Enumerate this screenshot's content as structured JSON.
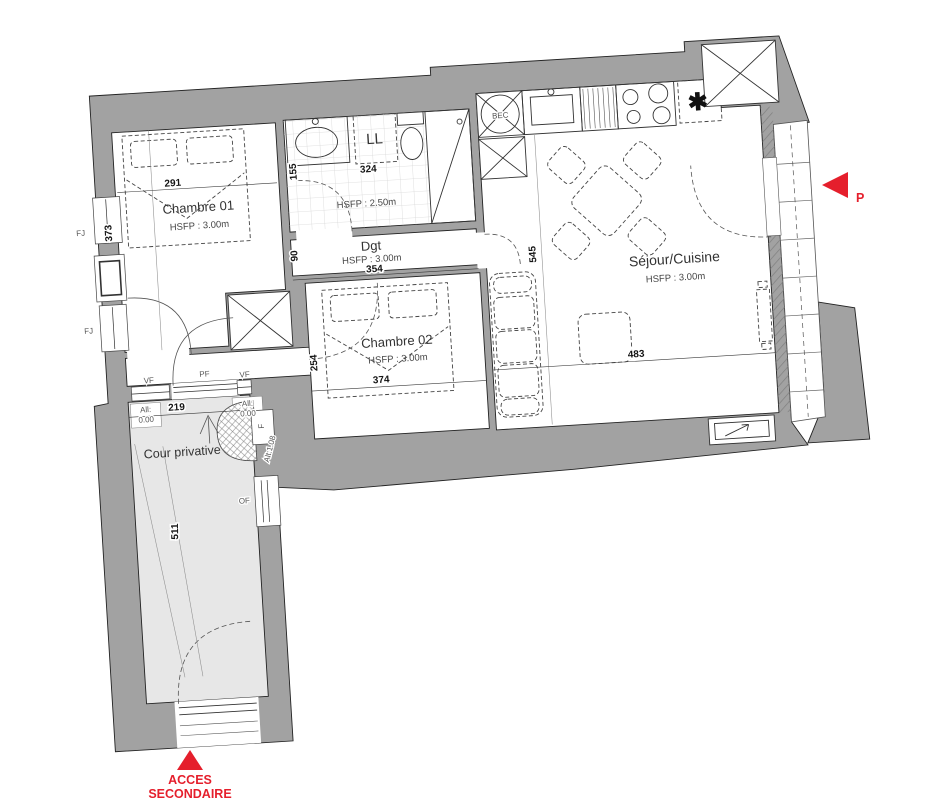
{
  "rooms": {
    "chambre01": {
      "label": "Chambre 01",
      "hsfp": "HSFP : 3.00m",
      "dim_width": "291",
      "dim_depth": "373"
    },
    "salle_eau": {
      "hsfp": "HSFP : 2.50m",
      "dim_width": "324",
      "dim_depth": "155",
      "washer_label": "LL"
    },
    "degagement": {
      "label": "Dgt",
      "hsfp": "HSFP : 3.00m",
      "dim_width": "354",
      "dim_depth": "90"
    },
    "chambre02": {
      "label": "Chambre 02",
      "hsfp": "HSFP : 3.00m",
      "dim_width": "374",
      "dim_depth": "254"
    },
    "sejour_cuisine": {
      "label": "Séjour/Cuisine",
      "hsfp": "HSFP : 3.00m",
      "dim_width": "483",
      "dim_depth": "545"
    },
    "cour": {
      "label": "Cour privative",
      "dim_width": "219",
      "dim_depth": "511"
    }
  },
  "openings": {
    "fj_upper": "FJ",
    "fj_lower": "FJ",
    "vf_left": "VF",
    "pf": "PF",
    "vf_right": "VF",
    "sill_left": {
      "label": "All:",
      "value": "0.00"
    },
    "sill_right": {
      "label": "All:",
      "value": "0.00"
    },
    "of": "OF",
    "f": "F",
    "alt": "Alt:1.08"
  },
  "fixtures": {
    "duct": "BEC",
    "fridge_mark": "✱"
  },
  "markers": {
    "principal": "P",
    "secondary": {
      "line1": "ACCES",
      "line2": "SECONDAIRE"
    }
  },
  "colors": {
    "wall": "#a2a2a2",
    "courtyard": "#e7e7e7",
    "accent": "#e51f2c",
    "line": "#232323"
  }
}
